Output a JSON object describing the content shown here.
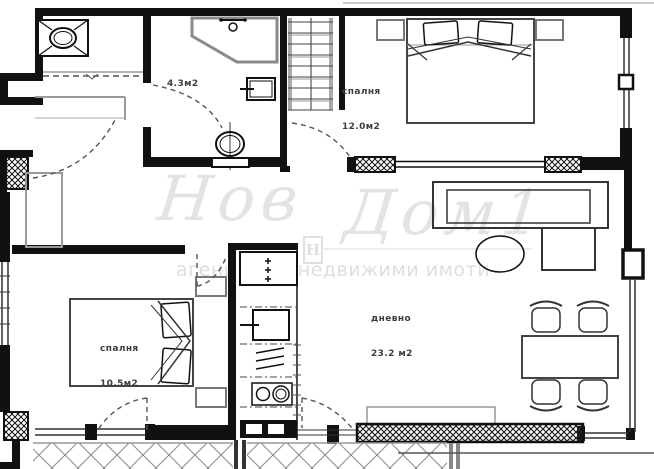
{
  "watermark": {
    "word1": "Нов",
    "word2": "Дом1",
    "logo_letter": "Н",
    "subtitle": "агенция за недвижими имоти"
  },
  "rooms": {
    "bathroom": {
      "area": "4.3м2"
    },
    "bedroom_top": {
      "name": "спалня",
      "area": "12.0м2"
    },
    "bedroom_left": {
      "name": "спалня",
      "area": "10.5м2"
    },
    "living": {
      "name": "дневно",
      "area": "23.2 м2"
    }
  },
  "colors": {
    "wall": "#111111",
    "thin_line": "#333333",
    "furniture_gray": "#888888",
    "watermark": "#e3e3e3",
    "label": "#3d3d3d",
    "background": "#ffffff"
  }
}
